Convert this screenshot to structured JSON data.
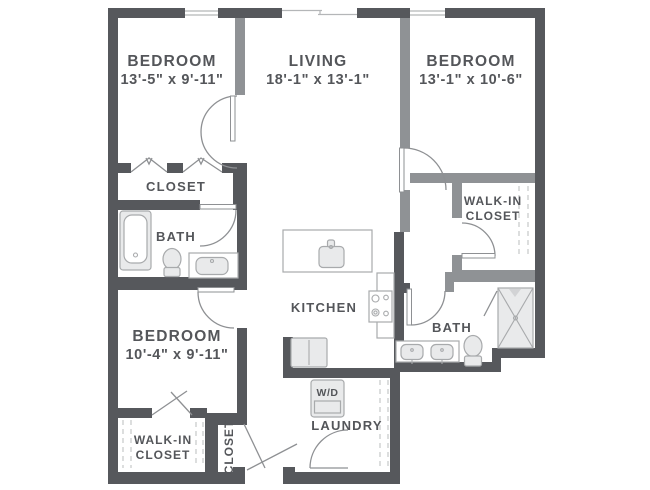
{
  "colors": {
    "wall": "#56585c",
    "wall_light": "#8f9295",
    "door": "#8e9093",
    "thin": "#b4b6b8",
    "dash": "#c6c7c9",
    "fixture_fill": "#e9eaeb",
    "fixture_stroke": "#a8aaac",
    "text": "#54565a"
  },
  "rooms": {
    "bedroom1": {
      "name": "BEDROOM",
      "dims": "13'-5\" x 9'-11\""
    },
    "living": {
      "name": "LIVING",
      "dims": "18'-1\" x 13'-1\""
    },
    "bedroom2": {
      "name": "BEDROOM",
      "dims": "13'-1\" x 10'-6\""
    },
    "bedroom3": {
      "name": "BEDROOM",
      "dims": "10'-4\" x 9'-11\""
    },
    "closet1": {
      "label": "CLOSET"
    },
    "bath1": {
      "label": "BATH"
    },
    "walkin1": {
      "line1": "WALK-IN",
      "line2": "CLOSET"
    },
    "kitchen": {
      "label": "KITCHEN"
    },
    "bath2": {
      "label": "BATH"
    },
    "walkin2": {
      "line1": "WALK-IN",
      "line2": "CLOSET"
    },
    "closet2": {
      "label": "CLOSET"
    },
    "laundry": {
      "label": "LAUNDRY"
    }
  },
  "fixtures": {
    "washer_dryer": "W/D"
  }
}
